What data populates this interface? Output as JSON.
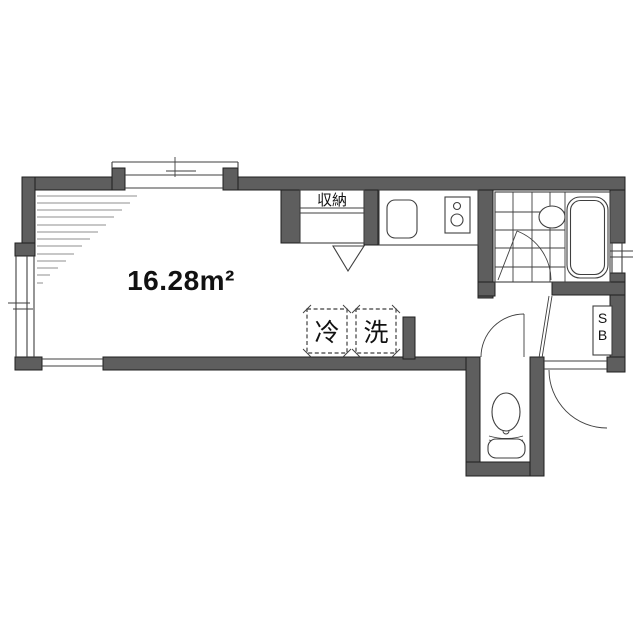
{
  "floorplan": {
    "area_label": "16.28m²",
    "closet_label": "収納",
    "fridge_label": "冷",
    "washer_label": "洗",
    "shoebox": {
      "top": "S",
      "bottom": "B"
    }
  },
  "colors": {
    "bg": "#ffffff",
    "wall": "#5e5e5e",
    "wallline": "#1f1f1f",
    "line": "#3f3f3f",
    "hatch": "#8f8f8f",
    "text": "#111111"
  }
}
